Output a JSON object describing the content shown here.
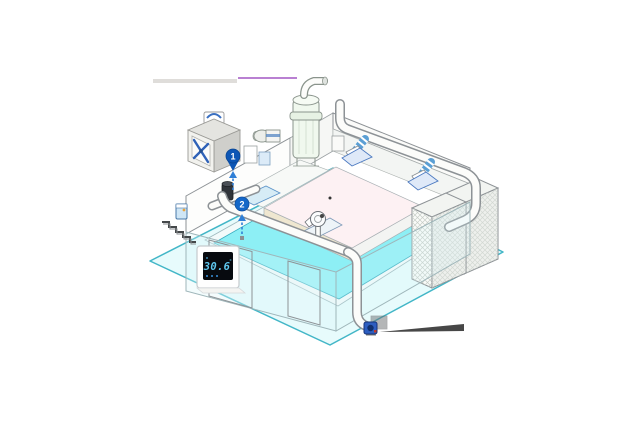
{
  "scene": {
    "background": "#ffffff",
    "description": "Isometric cutaway illustration of an indoor swimming pool hall with ventilation and dehumidification equipment"
  },
  "thermostat": {
    "reading": "30.6",
    "degree_mark": "°"
  },
  "markers": [
    {
      "label": "1",
      "type": "pin"
    },
    {
      "label": "2",
      "type": "circle"
    }
  ],
  "icons": {
    "exhaust-fan-icon": "X-blade axial fan in grey housing",
    "duct-icon": "white rounded ventilation duct",
    "flex-coupling-icon": "blue striped flexible duct connector",
    "diffuser-icon": "ceiling air diffuser on blue base plate",
    "pin-icon": "blue numbered location pin",
    "airflow-arrow-icon": "blue dashed upward airflow arrow",
    "thermostat-icon": "wall thermostat with digital display",
    "outlet-fan-icon": "small blue duct outlet fan"
  },
  "colors": {
    "water": "#8DEFF5",
    "apron": "#E7FBFC",
    "apron_edge": "#42B6C7",
    "outline": "#8D9296",
    "marker_blue": "#1467C8",
    "pin_blue": "#0D56B5",
    "arrow_blue": "#2F7FD6",
    "flex_coupling": "#5B9FD4",
    "fan_blade": "#2F62B8",
    "platform": "#FDF1F3",
    "bench_cream": "#EFE7D0",
    "thermostat_screen": "#070A0F",
    "thermostat_digits": "#5FC8F0",
    "outlet_fan": "#2D5EC0",
    "leader_purple": "#A257C4",
    "leader_gray": "#B7B3AD",
    "leader_dark": "#474747"
  },
  "components": [
    {
      "name": "exterior-exhaust-fan"
    },
    {
      "name": "roof-duct-sensor"
    },
    {
      "name": "treatment-column"
    },
    {
      "name": "circulation-pump"
    },
    {
      "name": "supply-duct"
    },
    {
      "name": "ceiling-diffusers"
    },
    {
      "name": "dehumidifier-cabinets"
    },
    {
      "name": "pool-water"
    },
    {
      "name": "wall-thermostat"
    },
    {
      "name": "duct-outlet-fan"
    },
    {
      "name": "entrance-steps"
    },
    {
      "name": "wall-control-box"
    }
  ]
}
